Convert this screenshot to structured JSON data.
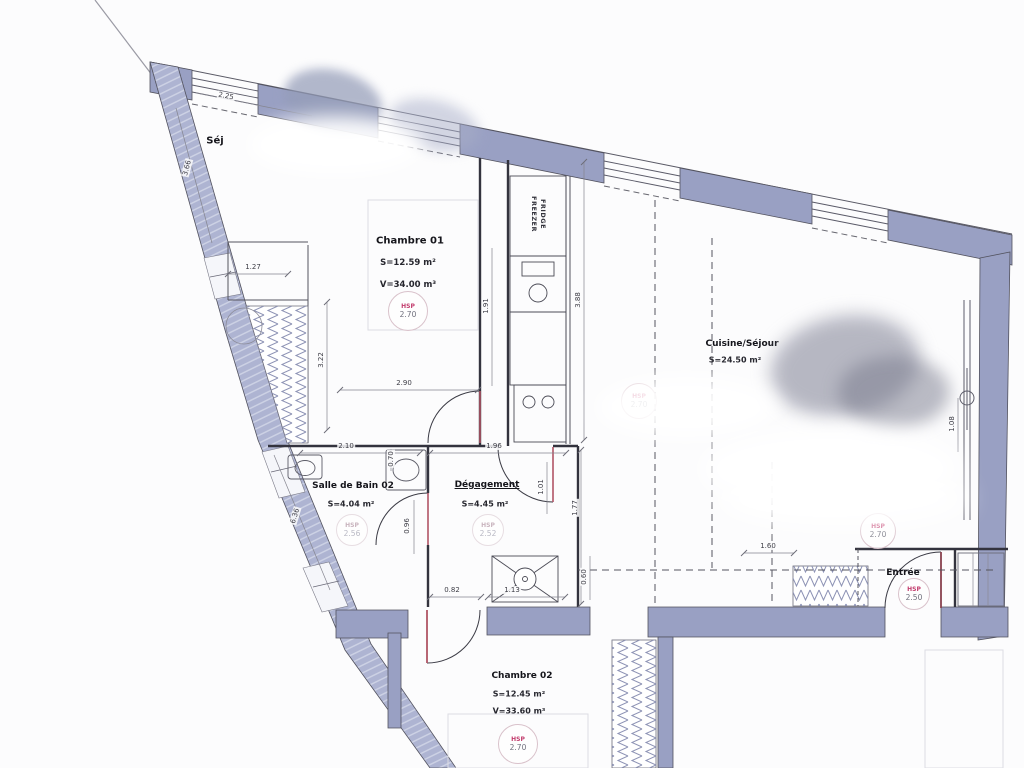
{
  "plan": {
    "rooms": {
      "sejour": {
        "name": "Séj"
      },
      "chambre01": {
        "name": "Chambre 01",
        "area": "S=12.59 m²",
        "volume": "V=34.00 m³"
      },
      "cuisine": {
        "name": "Cuisine/Séjour",
        "area": "S=24.50 m²"
      },
      "sdb": {
        "name": "Salle de Bain 02",
        "area": "S=4.04 m²",
        "hsp_label": "HSP",
        "hsp_value": "2.56"
      },
      "degagement": {
        "name": "Dégagement",
        "area": "S=4.45 m²",
        "hsp_label": "HSP",
        "hsp_value": "2.52"
      },
      "chambre02": {
        "name": "Chambre 02",
        "area": "S=12.45 m²",
        "volume": "V=33.60 m³"
      },
      "entree": {
        "name": "Entrée"
      }
    },
    "hsp": {
      "label": "HSP",
      "chambre01": "2.70",
      "cuisine_left": "2.70",
      "cuisine_right": "2.70",
      "entree": "2.50",
      "chambre02": "2.70"
    },
    "appliance": {
      "fridge": "FRIDGE",
      "freezer": "FREEZER"
    },
    "dimensions": [
      "2.25",
      "3.66",
      "1.27",
      "3.22",
      "2.90",
      "1.91",
      "3.88",
      "2.10",
      "0.70",
      "1.96",
      "1.01",
      "1.77",
      "6.36",
      "0.96",
      "0.82",
      "1.13",
      "0.60",
      "1.60",
      "1.08"
    ],
    "colors": {
      "wall": "#99a0c3",
      "wall_light": "#aeb4d2",
      "door_leaf": "#b05565",
      "hsp_red": "#c23c6d"
    }
  }
}
